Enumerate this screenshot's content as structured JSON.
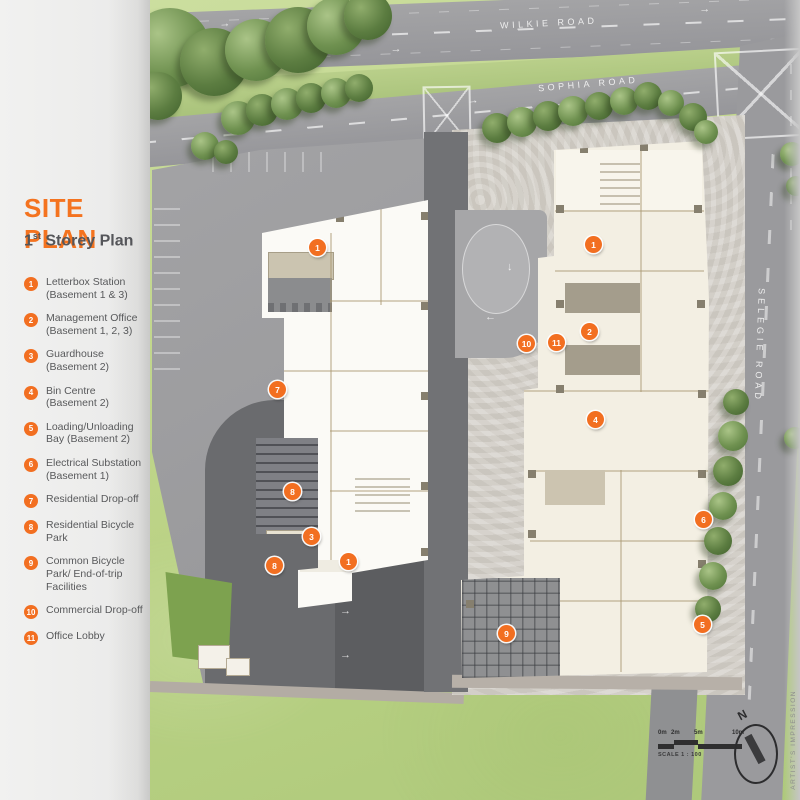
{
  "legend": {
    "title": "SITE PLAN",
    "subtitle": {
      "prefix": "1",
      "sup": "st",
      "rest": " Storey Plan"
    },
    "items": [
      {
        "num": "1",
        "label": "Letterbox Station (Basement 1 & 3)"
      },
      {
        "num": "2",
        "label": "Management Office (Basement 1, 2, 3)"
      },
      {
        "num": "3",
        "label": "Guardhouse (Basement 2)"
      },
      {
        "num": "4",
        "label": "Bin Centre (Basement 2)"
      },
      {
        "num": "5",
        "label": "Loading/Unloading Bay (Basement 2)"
      },
      {
        "num": "6",
        "label": "Electrical Substation (Basement 1)"
      },
      {
        "num": "7",
        "label": "Residential Drop-off"
      },
      {
        "num": "8",
        "label": "Residential Bicycle Park"
      },
      {
        "num": "9",
        "label": "Common Bicycle Park/ End-of-trip Facilities"
      },
      {
        "num": "10",
        "label": "Commercial Drop-off"
      },
      {
        "num": "11",
        "label": "Office Lobby"
      }
    ]
  },
  "roads": {
    "wilkie": "WILKIE ROAD",
    "sophia": "SOPHIA ROAD",
    "selegie": "SELEGIE ROAD"
  },
  "plan_markers": [
    {
      "num": "1",
      "x": 317,
      "y": 247
    },
    {
      "num": "7",
      "x": 277,
      "y": 389
    },
    {
      "num": "8",
      "x": 292,
      "y": 491
    },
    {
      "num": "3",
      "x": 311,
      "y": 536
    },
    {
      "num": "1",
      "x": 348,
      "y": 561
    },
    {
      "num": "8",
      "x": 274,
      "y": 565
    },
    {
      "num": "1",
      "x": 593,
      "y": 244
    },
    {
      "num": "2",
      "x": 589,
      "y": 331
    },
    {
      "num": "10",
      "x": 526,
      "y": 343
    },
    {
      "num": "11",
      "x": 556,
      "y": 342
    },
    {
      "num": "4",
      "x": 595,
      "y": 419
    },
    {
      "num": "6",
      "x": 703,
      "y": 519
    },
    {
      "num": "5",
      "x": 702,
      "y": 624
    },
    {
      "num": "9",
      "x": 506,
      "y": 633
    }
  ],
  "scale": {
    "t0": "0m",
    "t2": "2m",
    "t5": "5m",
    "t10": "10m",
    "caption": "SCALE 1 : 100"
  },
  "compass": {
    "north": "N"
  },
  "page": {
    "side_note": "ARTIST'S IMPRESSION"
  },
  "colors": {
    "accent_orange": "#F26F21",
    "legend_text": "#58595B",
    "grass": "#BFD48F",
    "road_gray": "#9B9B9D",
    "asphalt_dark": "#6B6C6E",
    "building_white": "#FBFAF6",
    "building_cream": "#F3EFE3",
    "plaza_paving": "#D4D0C9"
  }
}
